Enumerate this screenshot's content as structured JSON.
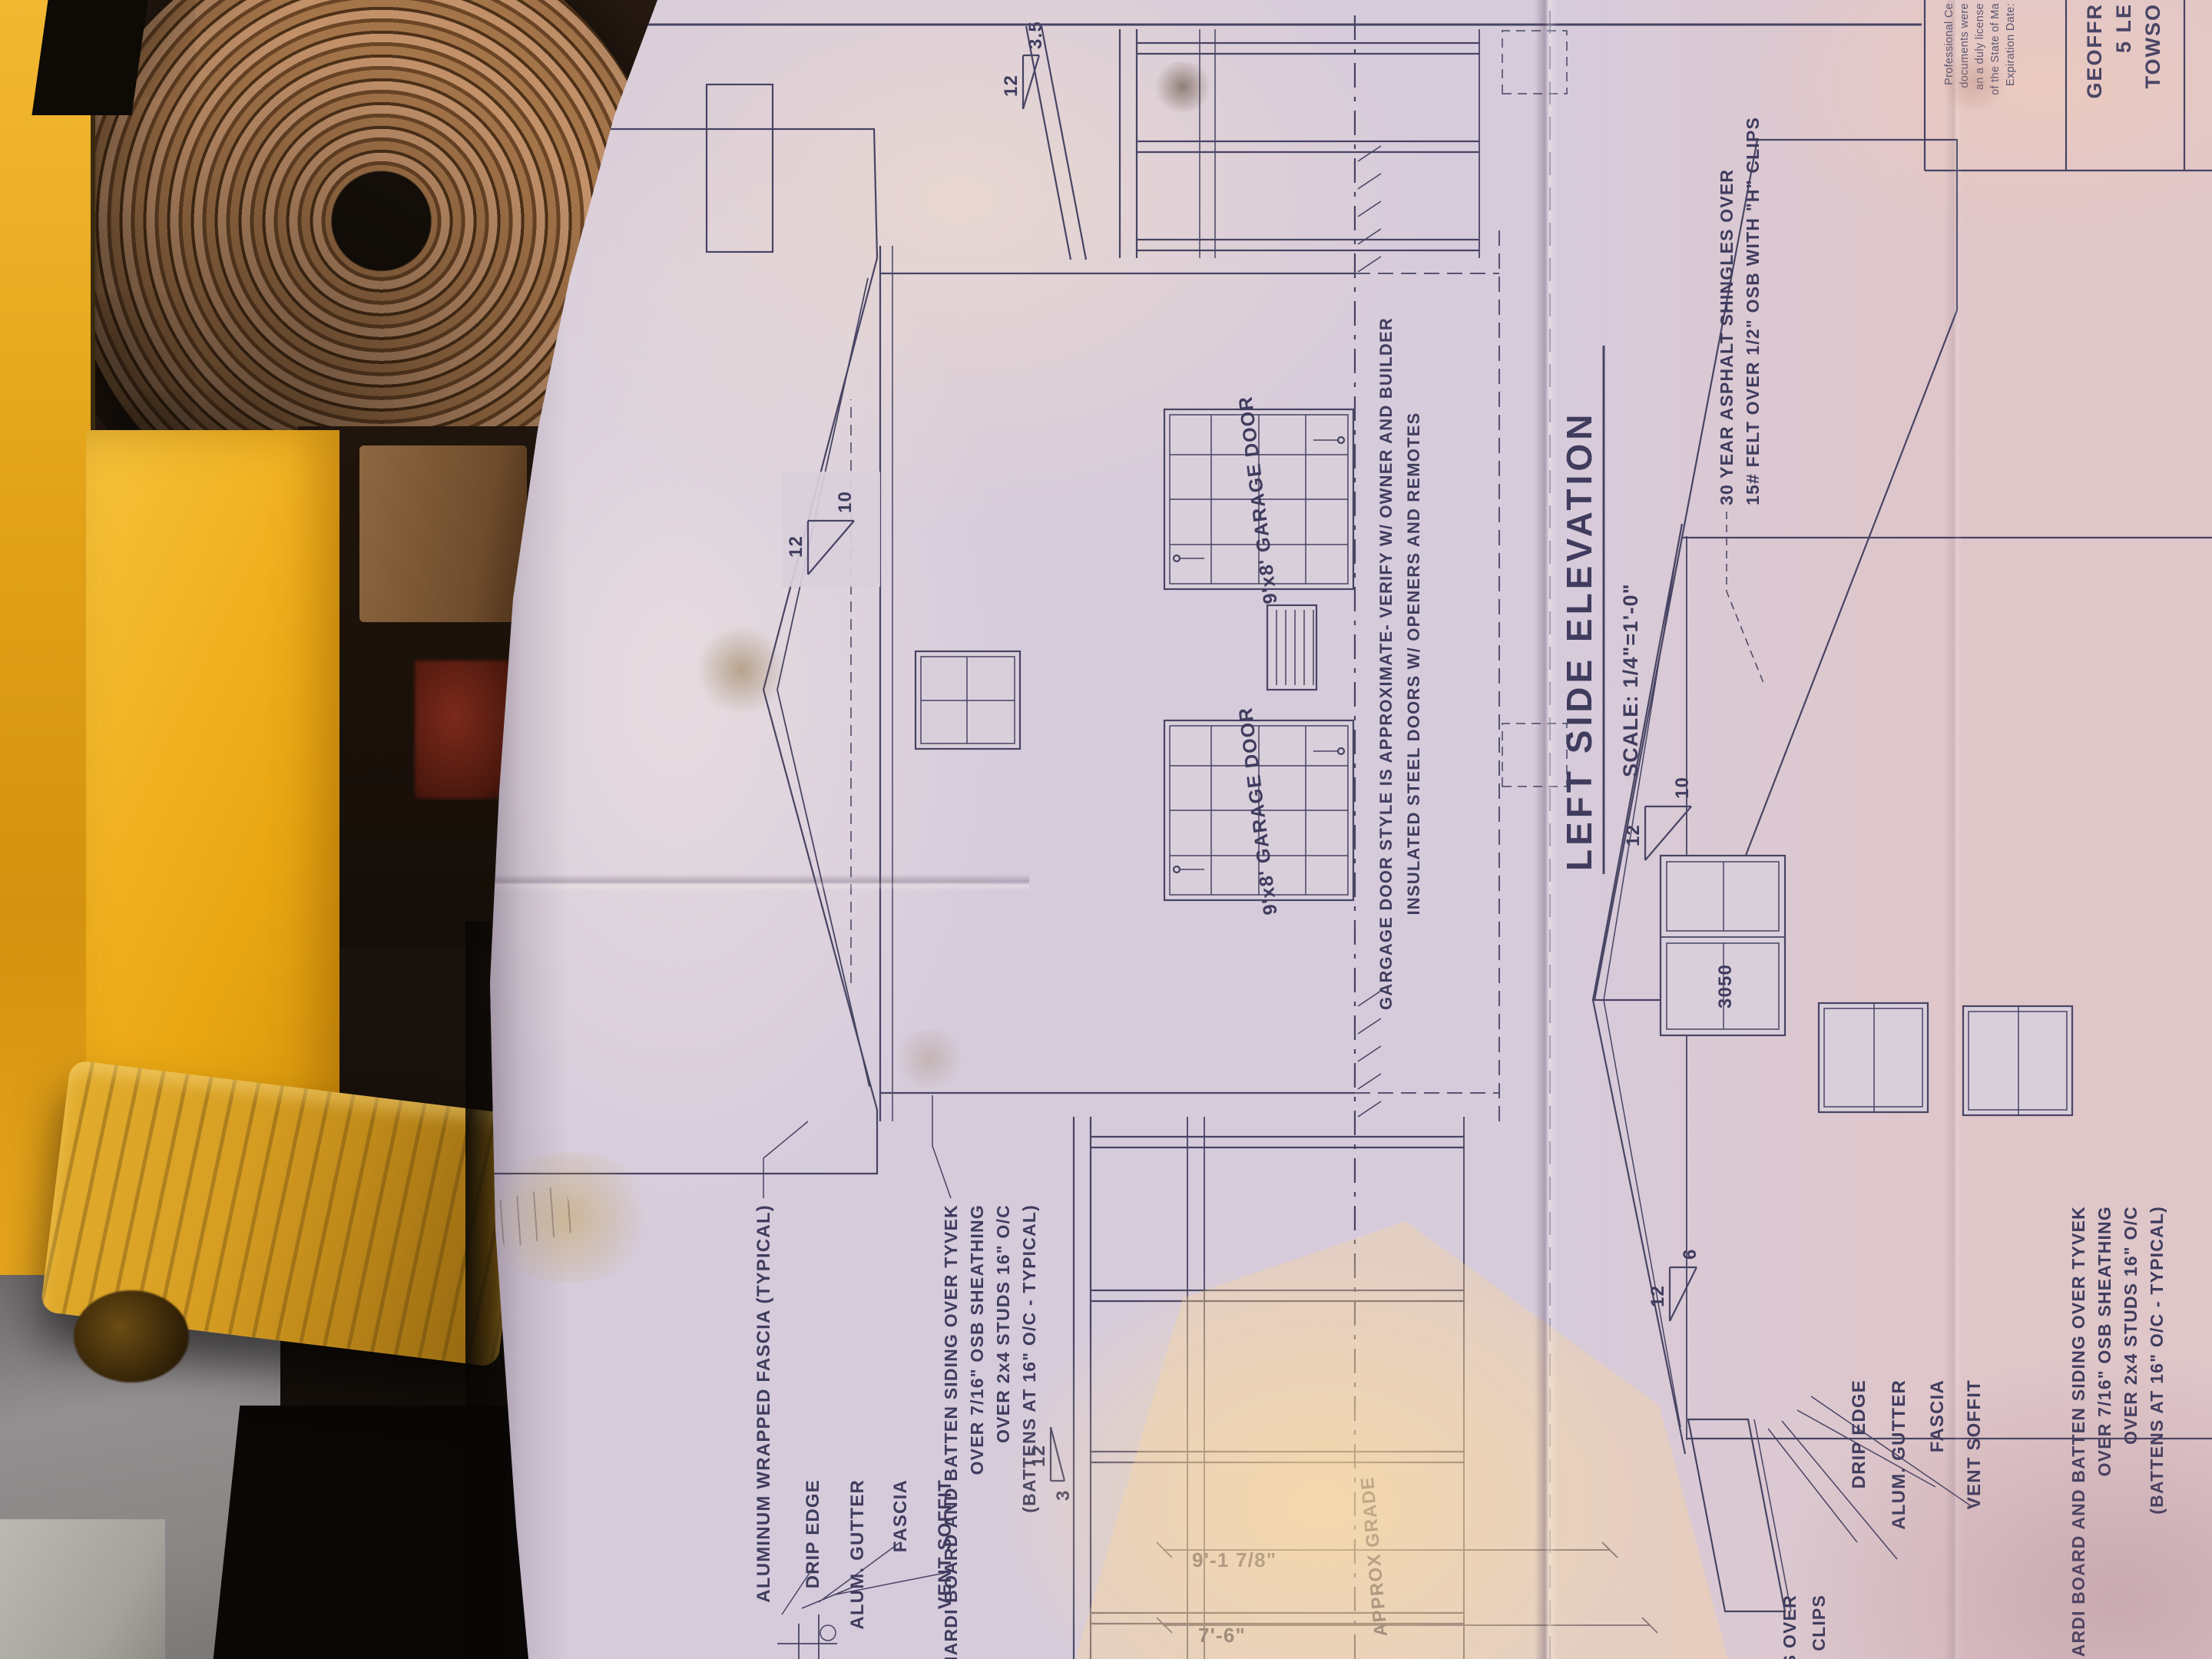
{
  "colors": {
    "ink": "#474463",
    "paper": "#d6cbdb",
    "machine_yellow": "#eda912"
  },
  "drawing": {
    "title": "LEFT SIDE ELEVATION",
    "scale": "SCALE: 1/4\"=1'-0\"",
    "eave_labels": [
      "DRIP EDGE",
      "ALUM. GUTTER",
      "FASCIA",
      "VENT SOFFIT"
    ],
    "garage_door_label": "9'x8' GARAGE DOOR",
    "window_label": "3050",
    "grade_label": "APPROX GRADE",
    "fascia_note": "ALUMINUM WRAPPED FASCIA (TYPICAL)",
    "siding_note": [
      "HARDI BOARD AND BATTEN SIDING OVER TYVEK",
      "OVER 7/16\" OSB SHEATHING",
      "OVER 2x4 STUDS 16\" O/C",
      "(BATTENS AT 16\" O/C - TYPICAL)"
    ],
    "garage_note": [
      "GARGAGE DOOR STYLE IS APPROXIMATE- VERIFY W/ OWNER AND BUILDER",
      "INSULATED STEEL DOORS W/ OPENERS AND REMOTES"
    ],
    "shingle_note": [
      "30 YEAR ASPHALT SHINGLES OVER",
      "15# FELT OVER 1/2\" OSB WITH \"H\" CLIPS"
    ],
    "shingle_note_fragments": [
      "LES OVER",
      "TH \"H\" CLIPS"
    ],
    "dim_wall_height": "9'-1 7/8\"",
    "dim_lower": "7'-6\"",
    "pitch_run": "12",
    "pitch_main": "10",
    "pitch_rear": "3.5",
    "pitch_porch_left": "3",
    "pitch_elev2_main": "10",
    "pitch_elev2_porch": "6",
    "titleblock": {
      "cert_lines": [
        "Professional Ce",
        "documents were",
        "an a duly license",
        "of the State of Ma",
        "Expiration Date:"
      ],
      "firm_lines": [
        "GEOFFR",
        "5 LE",
        "TOWSO"
      ]
    }
  }
}
